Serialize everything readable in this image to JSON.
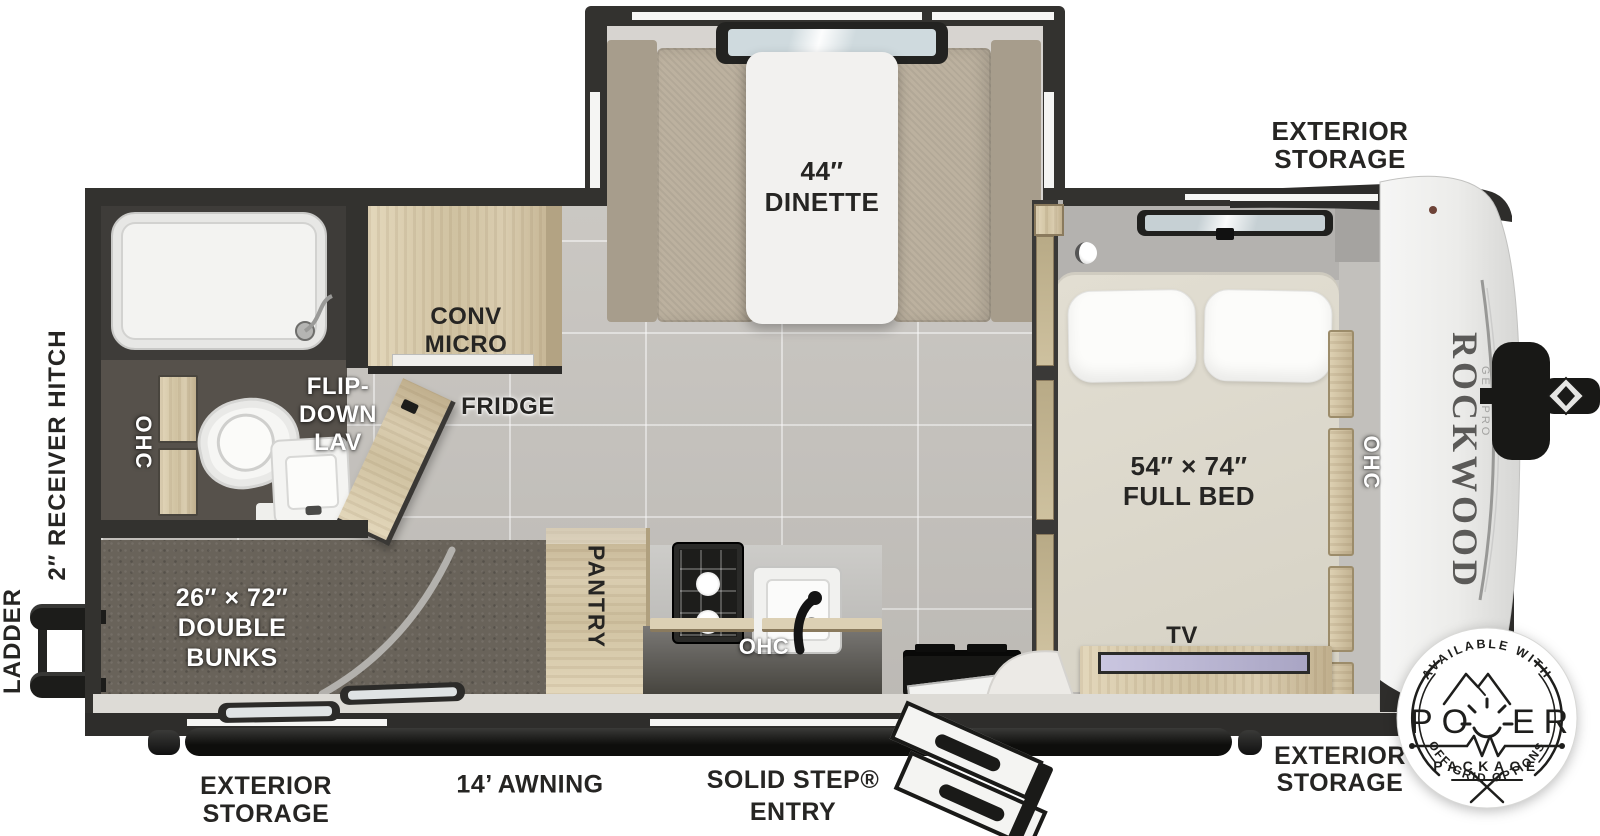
{
  "branding": {
    "name": "ROCKWOOD",
    "series": "GEO PRO"
  },
  "labels": {
    "exterior_storage_top": "EXTERIOR\nSTORAGE",
    "dinette": "44″\nDINETTE",
    "conv_micro": "CONV\nMICRO",
    "fridge": "FRIDGE",
    "flip_down_lav": "FLIP-\nDOWN\nLAV",
    "ohc_bath": "OHC",
    "receiver_hitch": "2″ RECEIVER HITCH",
    "ladder": "LADDER",
    "double_bunks": "26″ × 72″\nDOUBLE\nBUNKS",
    "pantry": "PANTRY",
    "ohc_kitchen": "OHC",
    "full_bed": "54″ × 74″\nFULL BED",
    "ohc_bed": "OHC",
    "tv": "TV",
    "exterior_storage_bottom_left": "EXTERIOR\nSTORAGE",
    "awning": "14’ AWNING",
    "solid_step_entry": "SOLID STEP®\nENTRY",
    "exterior_storage_bottom_right": "EXTERIOR\nSTORAGE"
  },
  "badge": {
    "arc_top": "AVAILABLE WITH",
    "power_start": "PO",
    "power_end": "ER",
    "package": "PACKAGE",
    "arc_bottom": "OFF-GRID OPTIONS"
  },
  "colors": {
    "wall": "#33322f",
    "floor_tile": "#c8c5c0",
    "wood": "#d5c8aa",
    "carpet": "#69635a",
    "awning": "#1a1a18"
  }
}
